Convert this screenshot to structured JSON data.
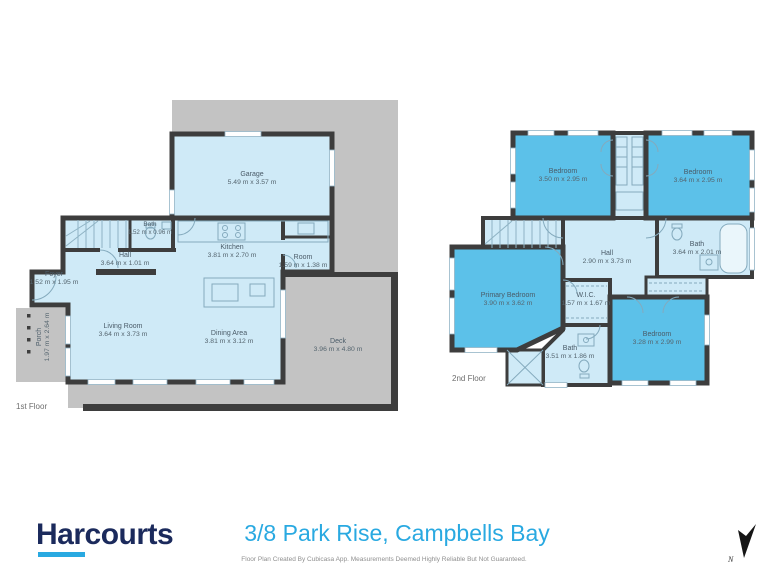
{
  "meta": {
    "brand": "Harcourts",
    "address": "3/8 Park Rise, Campbells Bay",
    "disclaimer": "Floor Plan Created By Cubicasa App. Measurements Deemed Highly Reliable But Not Guaranteed.",
    "north_label": "N"
  },
  "colors": {
    "room_light": "#cfeaf7",
    "room_dark": "#5cc1e9",
    "wall": "#3d3d3d",
    "exterior_grey": "#c3c3c3",
    "accent_cyan": "#29a9e1",
    "brand_navy": "#1b2a5c",
    "label_text": "#4a5b68"
  },
  "floors": [
    {
      "label": "1st Floor",
      "rooms": [
        {
          "name": "Garage",
          "dims": "5.49 m x 3.57 m"
        },
        {
          "name": "Bath",
          "dims": "1.52 m x 0.96 m"
        },
        {
          "name": "Kitchen",
          "dims": "3.81 m x 2.70 m"
        },
        {
          "name": "Room",
          "dims": "1.59 m x 1.38 m"
        },
        {
          "name": "Hall",
          "dims": "3.64 m x 1.01 m"
        },
        {
          "name": "Foyer",
          "dims": "1.52 m x 1.95 m"
        },
        {
          "name": "Living Room",
          "dims": "3.64 m x 3.73 m"
        },
        {
          "name": "Dining Area",
          "dims": "3.81 m x 3.12 m"
        },
        {
          "name": "Deck",
          "dims": "3.96 m x 4.80 m"
        },
        {
          "name": "Porch",
          "dims": "1.97 m x 2.64 m"
        }
      ]
    },
    {
      "label": "2nd Floor",
      "rooms": [
        {
          "name": "Bedroom",
          "dims": "3.50 m x 2.95 m"
        },
        {
          "name": "Bedroom",
          "dims": "3.64 m x 2.95 m"
        },
        {
          "name": "Hall",
          "dims": "2.90 m x 3.73 m"
        },
        {
          "name": "Bath",
          "dims": "3.64 m x 2.01 m"
        },
        {
          "name": "Primary Bedroom",
          "dims": "3.90 m x 3.62 m"
        },
        {
          "name": "W.I.C.",
          "dims": "1.57 m x 1.67 m"
        },
        {
          "name": "Bedroom",
          "dims": "3.28 m x 2.99 m"
        },
        {
          "name": "Bath",
          "dims": "3.51 m x 1.86 m"
        }
      ]
    }
  ]
}
